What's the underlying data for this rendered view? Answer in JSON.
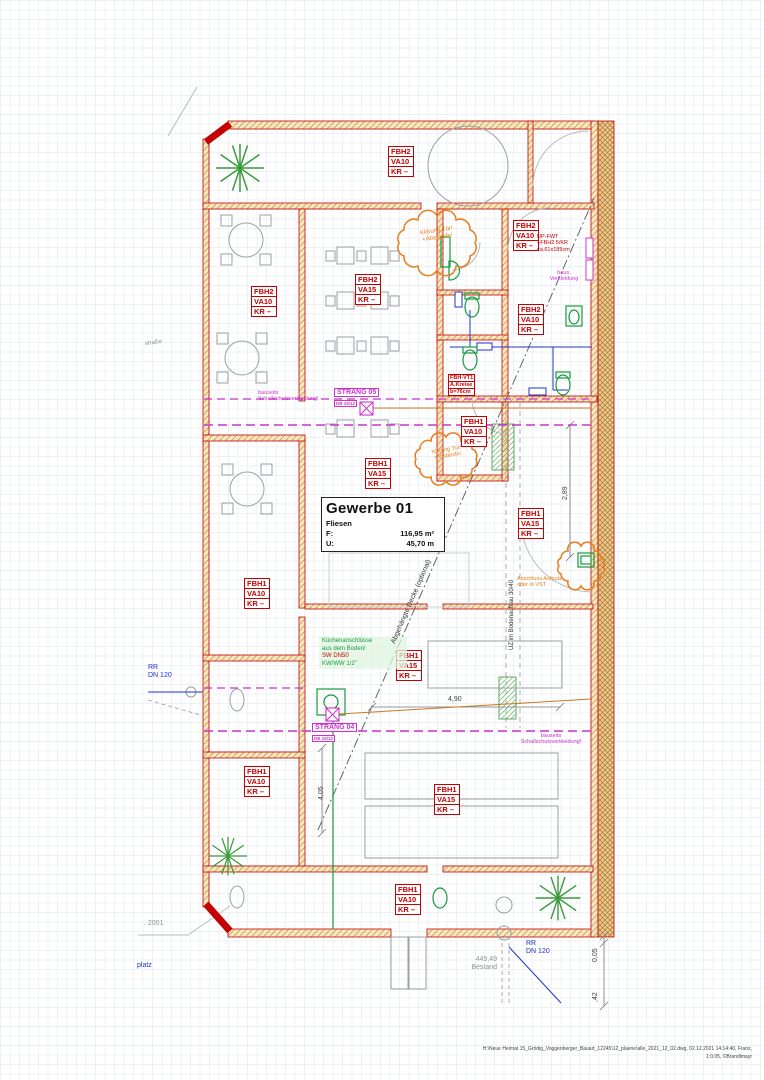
{
  "title_block": {
    "room_title": "Gewerbe 01",
    "room_finish": "Fliesen",
    "area_label": "F:",
    "area_value": "116,95 m²",
    "perimeter_label": "U:",
    "perimeter_value": "45,70 m"
  },
  "fbh_boxes": [
    {
      "l1": "FBH2",
      "l2": "VA10",
      "l3": "KR –"
    },
    {
      "l1": "FBH2",
      "l2": "VA10",
      "l3": "KR –"
    },
    {
      "l1": "FBH2",
      "l2": "VA15",
      "l3": "KR –"
    },
    {
      "l1": "FBH2",
      "l2": "VA10",
      "l3": "KR –"
    },
    {
      "l1": "FBH2",
      "l2": "VA10",
      "l3": "KR –"
    },
    {
      "l1": "FBH1",
      "l2": "VA10",
      "l3": "KR –"
    },
    {
      "l1": "FBH1",
      "l2": "VA15",
      "l3": "KR –"
    },
    {
      "l1": "FBH1",
      "l2": "VA15",
      "l3": "KR –"
    },
    {
      "l1": "FBH1",
      "l2": "VA10",
      "l3": "KR –"
    },
    {
      "l1": "FBH1",
      "l2": "VA15",
      "l3": "KR –"
    },
    {
      "l1": "FBH1",
      "l2": "VA10",
      "l3": "KR –"
    },
    {
      "l1": "FBH1",
      "l2": "VA15",
      "l3": "KR –"
    },
    {
      "l1": "FBH1",
      "l2": "VA10",
      "l3": "KR –"
    }
  ],
  "vt_box": {
    "l1": "FBH-VT1",
    "l2": "A.Kreise",
    "l3": "b=76cm"
  },
  "notes": {
    "cloud_top_1": "Klärung Tür!",
    "cloud_top_2": "+Abstände!",
    "cloud_mid_1": "Klärung Tür!",
    "cloud_mid_2": "+Abstände!",
    "upfwt_1": "UP-FWT",
    "upfwt_2": "+FBH2 5/KR",
    "upfwt_3": "ca.61x185cm",
    "baus_1": "baus.",
    "baus_2": "Verkleidung",
    "schall_left_1": "bauseits",
    "schall_left_2": "Schallschutzverkleidung!",
    "schall_bot_1": "bauseits",
    "schall_bot_2": "Schallschutzverkleidung!",
    "kueche_1": "Küchenanschlüsse",
    "kueche_2": "aus dem Boden!",
    "kueche_3": "SW DN50",
    "kueche_4": "KW/WW 1/2\"",
    "anschluss_1": "Anschluss Aufputz",
    "anschluss_2": "oder in VST",
    "decke": "Abgehängte Decke (optional)",
    "uz": "UZ im Bodenaufbau 30/40"
  },
  "strang": {
    "s05": "STRANG 05",
    "s05_sub": "DB 15/12",
    "s04": "STRANG 04",
    "s04_sub": "DB 15/12"
  },
  "pipes": {
    "rr_left_1": "RR",
    "rr_left_2": "DN 120",
    "rr_bottom_1": "RR",
    "rr_bottom_2": "DN 120"
  },
  "dims": {
    "d289": "2,89",
    "d490": "4,90",
    "d405": "4,05",
    "d005": "0,05",
    "d42": ",42",
    "bestand_1": "449,49",
    "bestand_2": "Bestand"
  },
  "site": {
    "street": "straße",
    "num2001": ". 2001",
    "platz": "platz"
  },
  "footer": {
    "line1": "H:\\Neue Heimat 15_Grödig_Voggenberger_Bauart_12245\\12_plaene\\alle_2021_12_02.dwg, 02.12.2021 14:14:40, Franz,",
    "line2": "1:0.05, ©Brandlmayr"
  },
  "colors": {
    "wall_red": "#c40000",
    "magenta": "#cc33cc",
    "green": "#169a3c",
    "orange": "#e87f1e",
    "blue": "#2233cc",
    "wood": "#ecc98e"
  }
}
